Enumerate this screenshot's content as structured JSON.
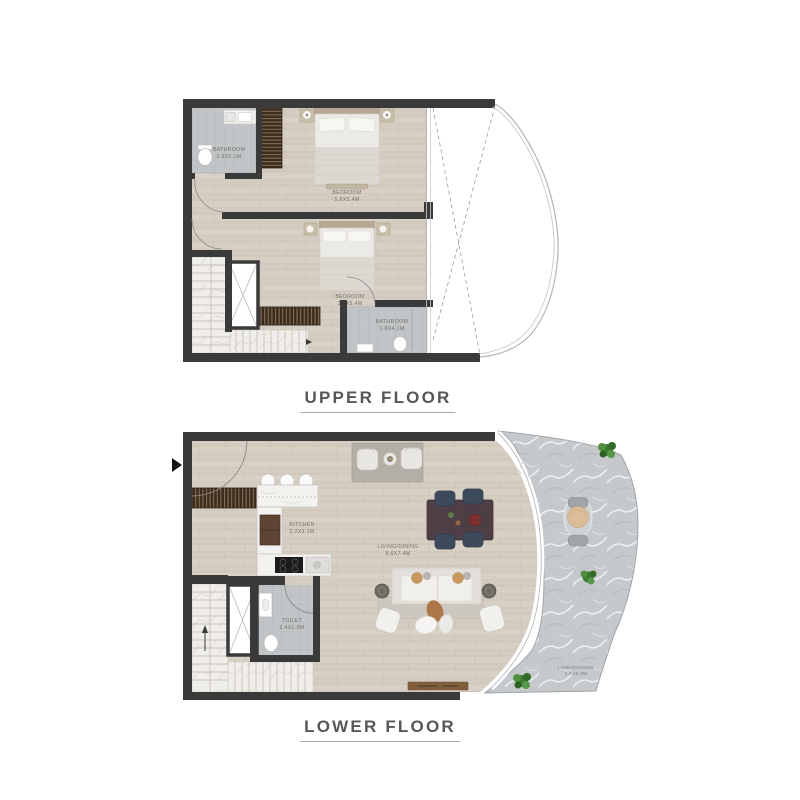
{
  "upper_floor": {
    "title": "UPPER FLOOR",
    "rooms": {
      "bathroom1": {
        "name": "BATHROOM",
        "dims": "2.3X2.1M"
      },
      "bedroom1": {
        "name": "BEDROOM",
        "dims": "5.8X3.4M"
      },
      "bedroom2": {
        "name": "BEDROOM",
        "dims": "3.2X5.4M"
      },
      "bathroom2": {
        "name": "BATHROOM",
        "dims": "1.8X4.1M"
      }
    }
  },
  "lower_floor": {
    "title": "LOWER FLOOR",
    "rooms": {
      "kitchen": {
        "name": "KITCHEN",
        "dims": "2.2X3.1M"
      },
      "living_dining": {
        "name": "LIVING/DINING",
        "dims": "8.6X7.4M"
      },
      "toilet": {
        "name": "TOILET",
        "dims": "2.4X1.8M"
      },
      "terrace": {
        "name": "LIVING/DINING",
        "dims": "2.0X8.8M"
      }
    }
  },
  "colors": {
    "wall": "#3a3a3a",
    "wood_floor": "#d8d0c5",
    "bathroom_tile": "#c2c5c7",
    "stair_marble": "#f0eeea",
    "terrace_marble": "#c6c9cc",
    "wardrobe_wood": "#3a2c20",
    "plant_green": "#3c7a31",
    "title_text": "#55575a",
    "label_text": "#74716a"
  }
}
